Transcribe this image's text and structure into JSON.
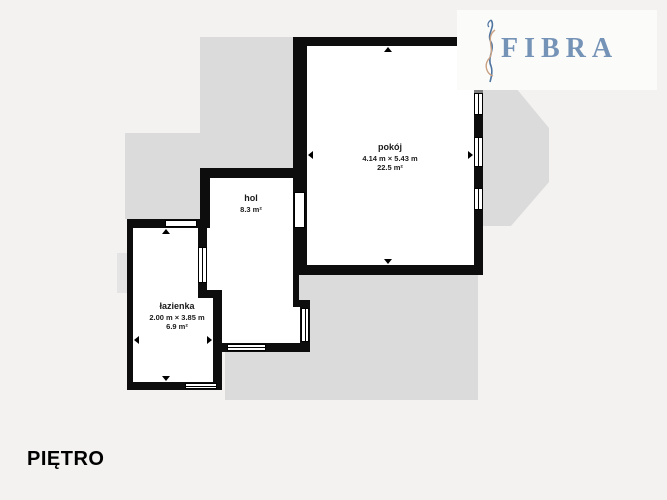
{
  "floor_plan": {
    "floor_label": "PIĘTRO",
    "brand": "FIBRA",
    "rooms": [
      {
        "name": "pokój",
        "dimensions": "4.14 m × 5.43 m",
        "area": "22.5 m²"
      },
      {
        "name": "hol",
        "dimensions": "",
        "area": "8.3 m²"
      },
      {
        "name": "łazienka",
        "dimensions": "2.00 m × 3.85 m",
        "area": "6.9 m²"
      }
    ],
    "colors": {
      "wall": "#0d0d0d",
      "wall_under_roof": "#7e7e7e",
      "roof_area": "#dbdbdb",
      "background": "#f3f2f0",
      "brand_blue": "#7593b6",
      "brand_tan": "#c9a183"
    }
  }
}
